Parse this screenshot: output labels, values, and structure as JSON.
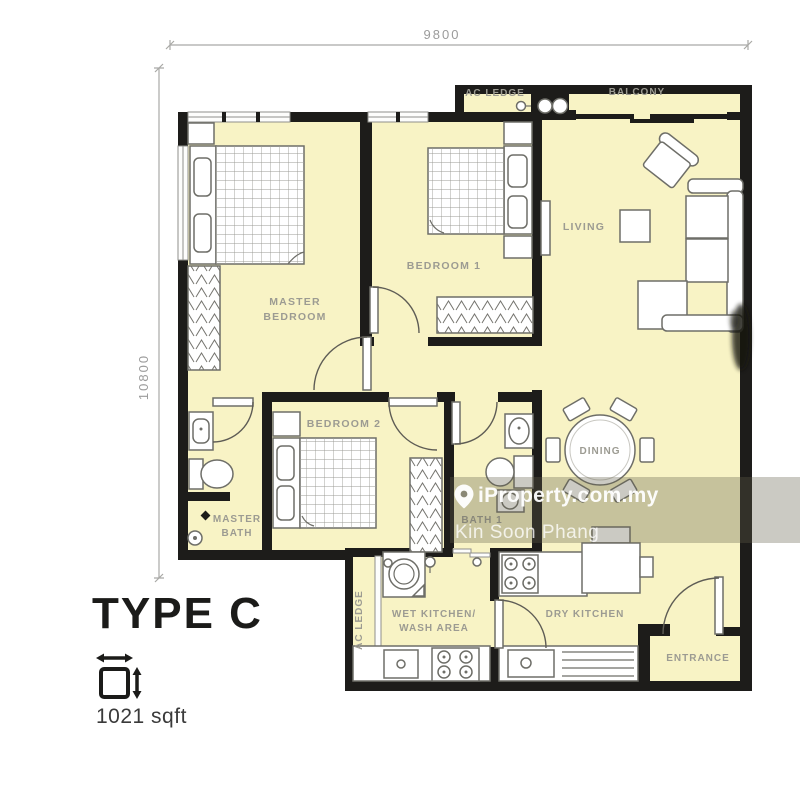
{
  "floorplan": {
    "title": "TYPE C",
    "area": "1021 sqft",
    "dimensions": {
      "width": "9800",
      "height": "10800"
    },
    "rooms": {
      "ac_ledge_top": "AC LEDGE",
      "balcony": "BALCONY",
      "living": "LIVING",
      "bedroom1": "BEDROOM 1",
      "master_bedroom_line1": "MASTER",
      "master_bedroom_line2": "BEDROOM",
      "bedroom2": "BEDROOM 2",
      "master_bath_line1": "MASTER",
      "master_bath_line2": "BATH",
      "bath1": "BATH 1",
      "dining": "DINING",
      "wet_kitchen_line1": "WET KITCHEN/",
      "wet_kitchen_line2": "WASH AREA",
      "dry_kitchen": "DRY KITCHEN",
      "entrance": "ENTRANCE",
      "ac_ledge_left": "AC LEDGE"
    },
    "watermark": {
      "brand": "iProperty.com.my",
      "agent": "Kin Soon Phang"
    },
    "icons": {
      "size_icon": "width-height-measure-arrows",
      "location_pin_icon": "map-pin"
    },
    "colors": {
      "room_fill": "#F8F3C5",
      "wall": "#1D1C1A",
      "label_text": "#9C9B92",
      "furniture_stroke": "#6E6E68",
      "dimension_text": "#9B9B9B",
      "watermark_band": "rgba(96,95,74,0.33)",
      "watermark_text": "#FFFFFF"
    }
  }
}
